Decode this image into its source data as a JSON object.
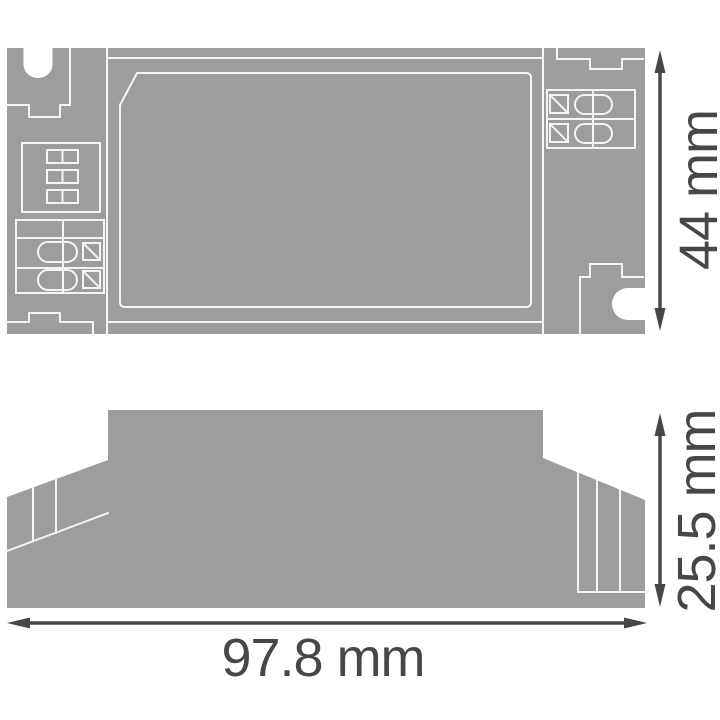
{
  "document": {
    "type": "dimension-drawing",
    "views": {
      "top_view": "top view",
      "side_view": "side view"
    }
  },
  "dims": {
    "height": {
      "value": "44",
      "unit": "mm",
      "label": "44 mm"
    },
    "depth": {
      "value": "25.5",
      "unit": "mm",
      "label": "25.5 mm"
    },
    "width": {
      "value": "97.8",
      "unit": "mm",
      "label": "97.8 mm"
    }
  },
  "colors": {
    "body_gray": "#9d9d9d",
    "outline_white": "#f4f4f4",
    "dimension_dark": "#474747",
    "background": "#ffffff"
  }
}
